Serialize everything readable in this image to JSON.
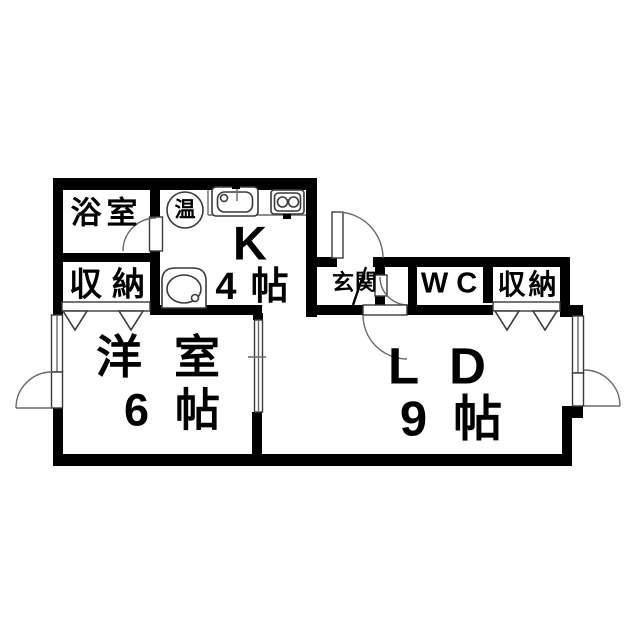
{
  "document": {
    "type": "apartment-floor-plan",
    "background": "#ffffff",
    "wall_color": "#000000",
    "line_color": "#555555"
  },
  "rooms": {
    "bathroom": {
      "label": "浴室"
    },
    "storage_left": {
      "label": "収納"
    },
    "water_heater": {
      "label": "温"
    },
    "kitchen": {
      "label": "K",
      "size": "4帖"
    },
    "entrance": {
      "label": "玄関"
    },
    "wc": {
      "label": "WC"
    },
    "storage_right": {
      "label": "収納"
    },
    "western_room": {
      "label": "洋室",
      "size": "6帖"
    },
    "living_dining": {
      "label": "LD",
      "size": "9帖"
    }
  },
  "fixtures": {
    "water_heater": "water-heater-circle",
    "kitchen_sink": "kitchen-sink",
    "stove": "two-burner-stove",
    "basin": "wash-basin",
    "windows": [
      "left-wall-window",
      "right-wall-window"
    ],
    "doors": [
      "entrance-door",
      "bathroom-door",
      "wc-door",
      "ld-door",
      "left-exterior-door",
      "right-exterior-door"
    ],
    "closet_fronts": [
      "storage-left-folding-door",
      "storage-right-folding-door"
    ],
    "partition": "sliding-door-western-room-ld"
  }
}
